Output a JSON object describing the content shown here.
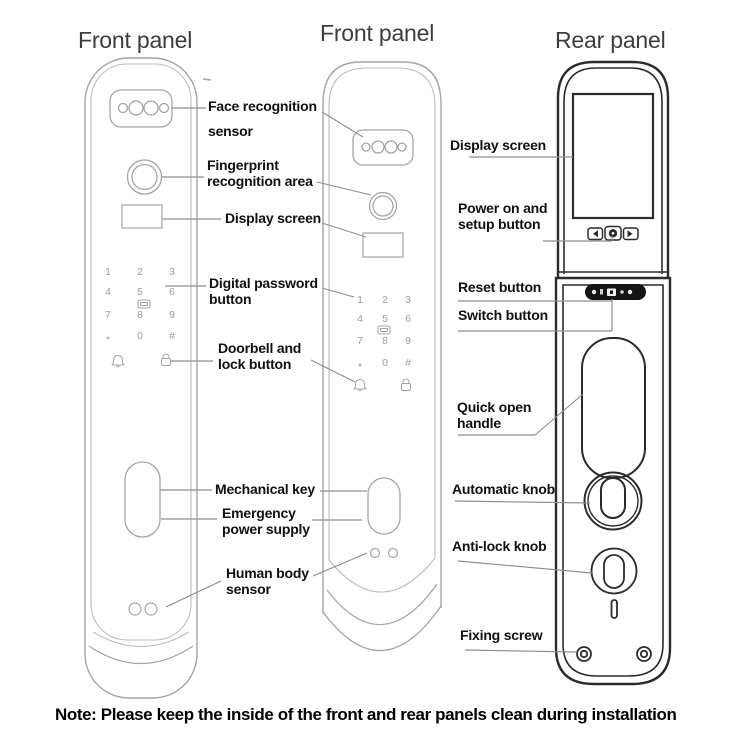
{
  "titles": {
    "front_left": "Front panel",
    "front_middle": "Front panel",
    "rear": "Rear panel"
  },
  "labels": {
    "face_recognition": "Face recognition\nsensor",
    "fingerprint": "Fingerprint\nrecognition area",
    "display_front": "Display screen",
    "digital_password": "Digital password\nbutton",
    "doorbell_lock": "Doorbell and\nlock button",
    "mechanical_key": "Mechanical key",
    "emergency_power": "Emergency\npower supply",
    "human_body": "Human body\nsensor",
    "display_rear": "Display screen",
    "power_setup": "Power on and\nsetup button",
    "reset": "Reset button",
    "switch": "Switch button",
    "quick_open": "Quick open\nhandle",
    "automatic_knob": "Automatic knob",
    "anti_lock": "Anti-lock knob",
    "fixing_screw": "Fixing screw"
  },
  "keypad": {
    "keys": [
      "1",
      "2",
      "3",
      "4",
      "5",
      "6",
      "7",
      "8",
      "9",
      "*",
      "0",
      "#"
    ]
  },
  "icons": {
    "doorbell": "bell-icon",
    "lock": "padlock-icon",
    "card": "keycard-icon",
    "prev": "left-arrow-icon",
    "camera": "camera-button-icon",
    "next": "right-arrow-icon"
  },
  "note": "Note: Please keep the inside of the front and rear panels clean during installation",
  "colors": {
    "front_line": "#a4a4a4",
    "rear_line": "#2b2b2b",
    "leader_line": "#8d8d8d",
    "key_text": "#9c9c9c",
    "label_text": "#101010",
    "title_text": "#3d3d3d",
    "pill_fill": "#141414"
  }
}
